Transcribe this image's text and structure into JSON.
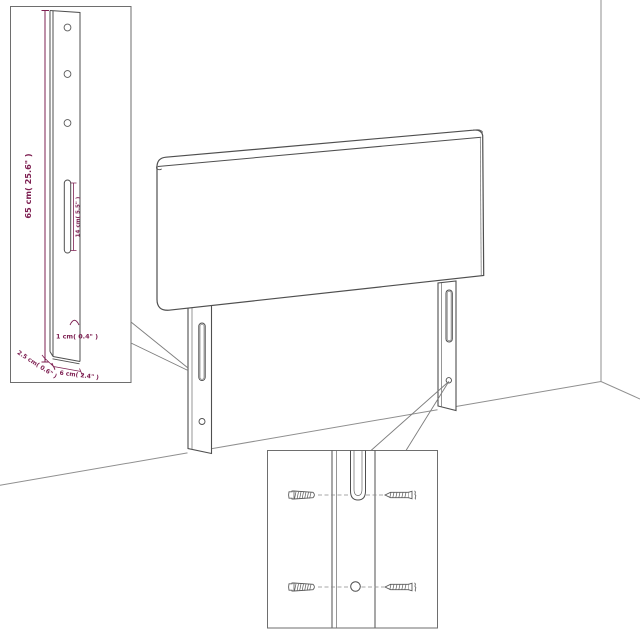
{
  "illustration": {
    "subject": "headboard-with-legs-line-drawing",
    "views": [
      "room-perspective",
      "leg-dimension-detail",
      "wall-mounting-detail"
    ]
  },
  "dimensions": {
    "leg_height": "65 cm( 25.6\" )",
    "slot_length": "14 cm( 5.5\" )",
    "hole_diameter": "1 cm( 0.4\" )",
    "leg_depth": "2.5 cm( 0.6\" )",
    "leg_width": "6 cm( 2.4\" )"
  },
  "colors": {
    "dimension_text": "#7E2052",
    "drawing_line": "#4F4F4F",
    "wall_line": "#8F8F8F",
    "inset_border": "#6E6E6E",
    "background": "#FFFFFF"
  },
  "icons": {
    "fasteners": [
      "wall-plug-icon",
      "screw-icon"
    ],
    "callouts": [
      "leg-detail-inset",
      "mounting-detail-inset"
    ]
  }
}
